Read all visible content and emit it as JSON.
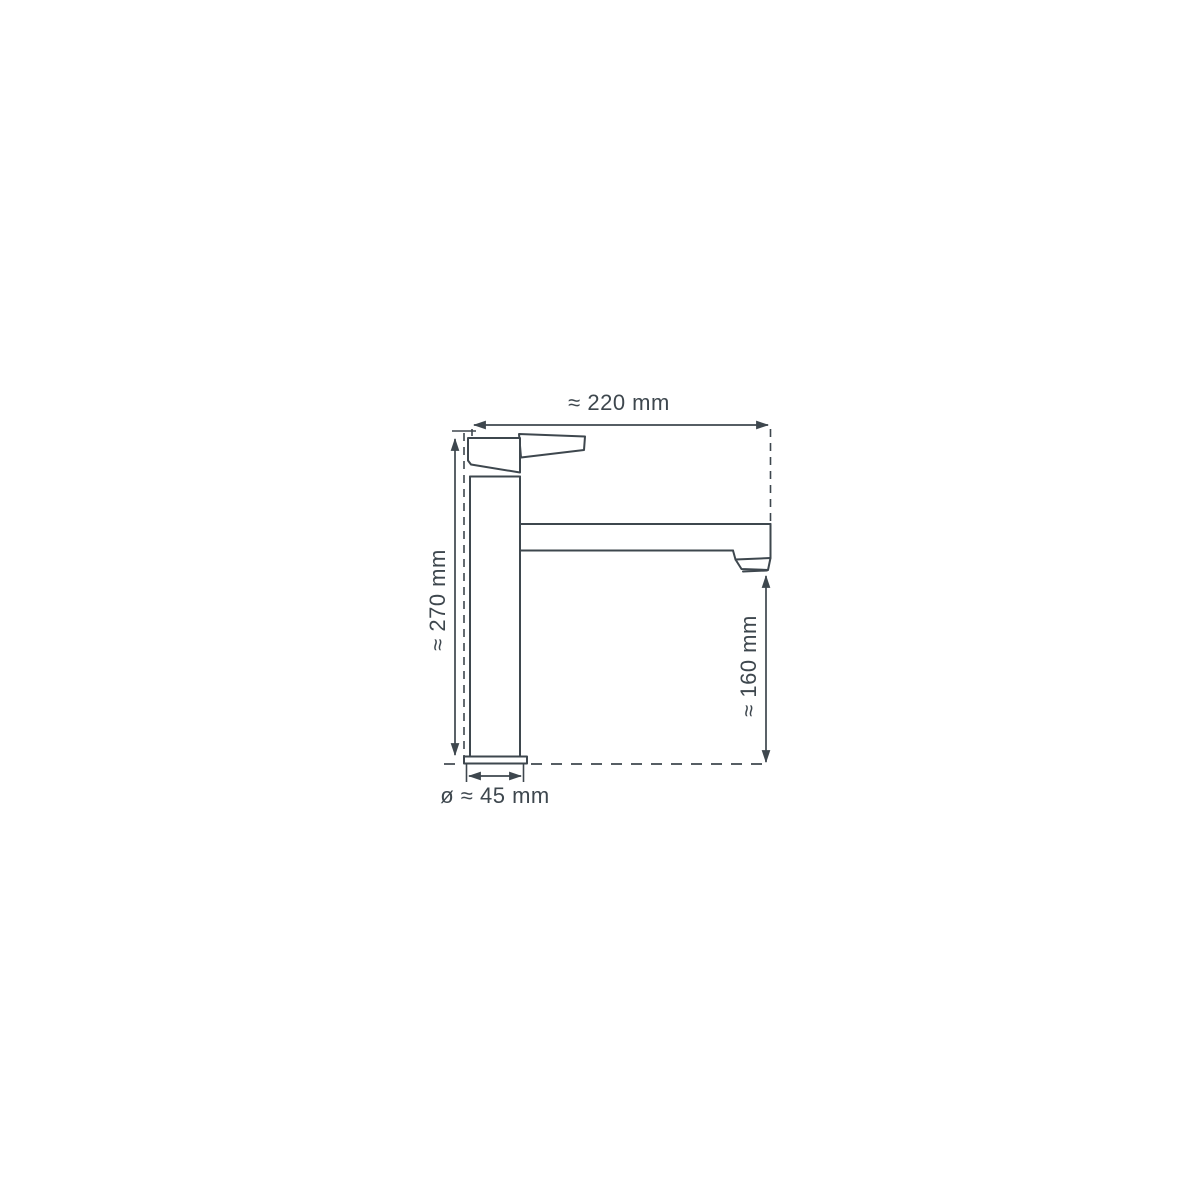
{
  "diagram": {
    "colors": {
      "ink": "#3e474e",
      "background": "#ffffff"
    },
    "labels": {
      "width_top": "≈ 220 mm",
      "height_left": "≈ 270 mm",
      "spout_height_right": "≈ 160 mm",
      "base_diameter": "ø ≈ 45 mm"
    }
  }
}
